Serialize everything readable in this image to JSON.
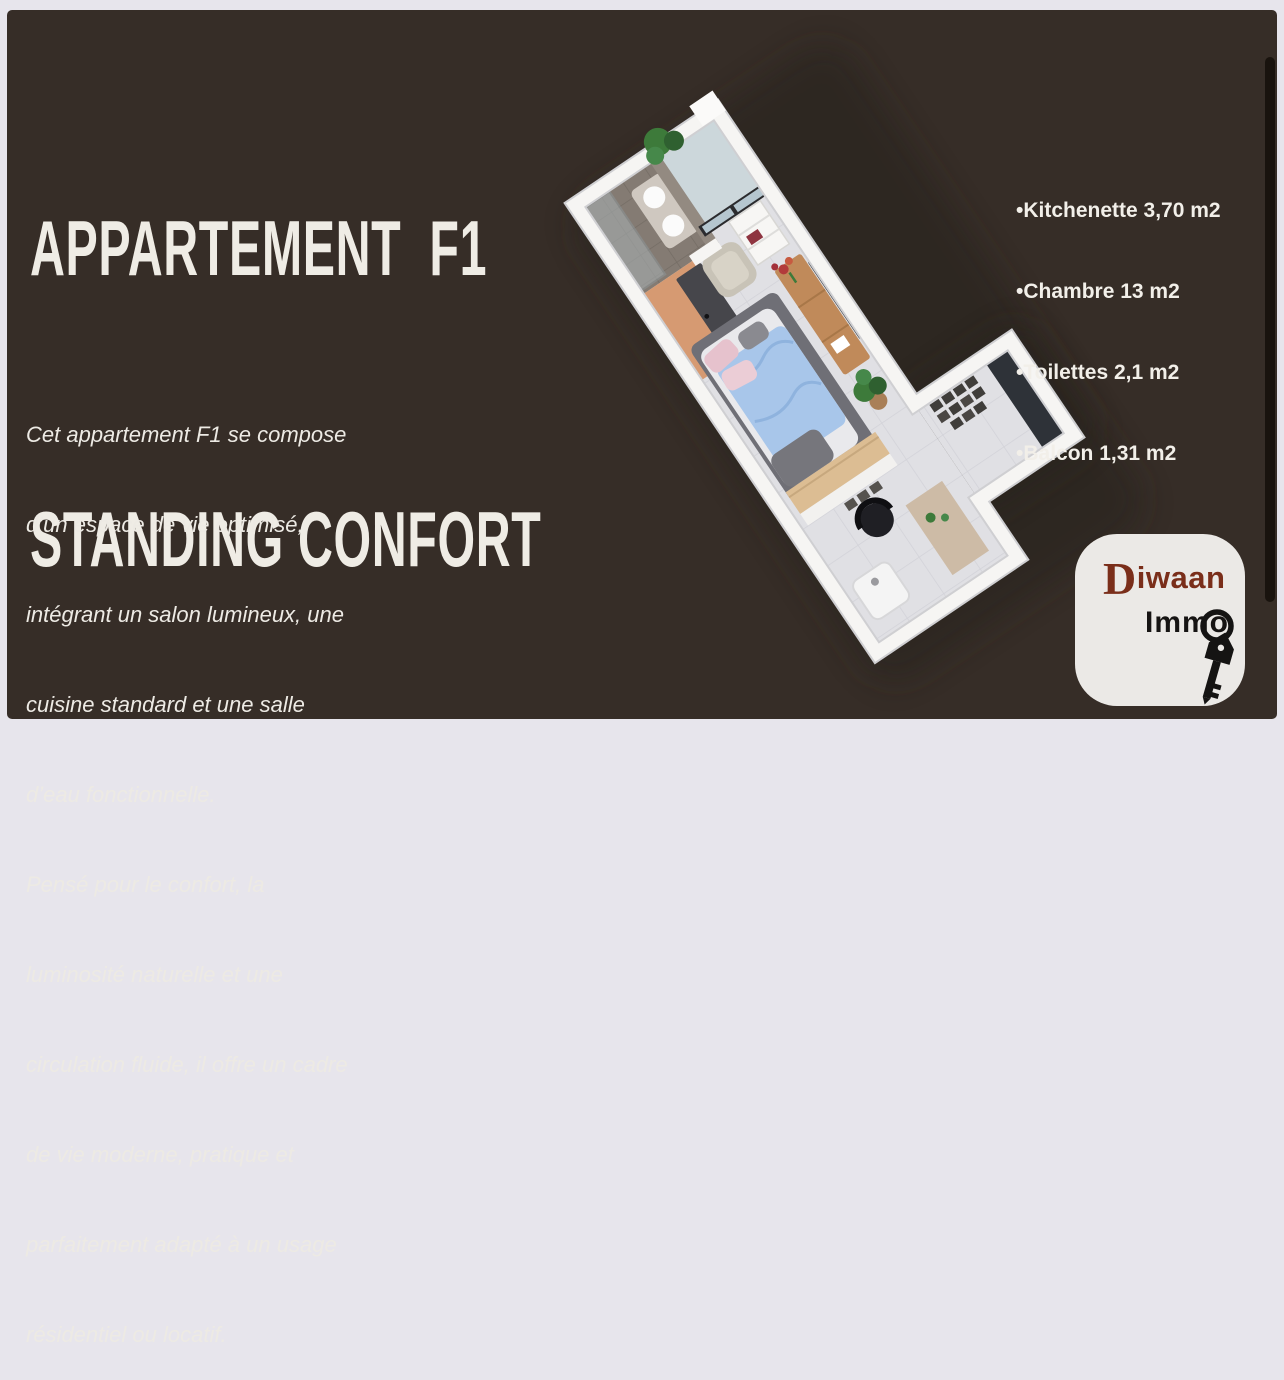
{
  "frame": {
    "outer_bg": "#e7e5ec",
    "card_bg": "#362d27"
  },
  "title": {
    "line1": "APPARTEMENT  F1",
    "line2": "STANDING CONFORT",
    "color": "#efece5"
  },
  "areas": {
    "items": [
      "•Kitchenette 3,70 m2",
      "•Chambre 13 m2",
      "•Toilettes 2,1 m2",
      "•Balcon 1,31 m2"
    ]
  },
  "description": {
    "lines": [
      "Cet appartement F1 se compose",
      "d’un espace de vie optimisé,",
      "intégrant un salon lumineux, une",
      "cuisine standard et une salle",
      "d’eau fonctionnelle.",
      "Pensé pour le confort, la",
      "luminosité naturelle et une",
      "circulation fluide, il offre un cadre",
      "de vie moderne, pratique et",
      "parfaitement adapté à un usage",
      "résidentiel ou locatif."
    ]
  },
  "logo": {
    "brand_initial": "D",
    "brand_rest": "iwaan",
    "sub": "Immo",
    "brand_color": "#7a2e1a",
    "sub_color": "#161413",
    "box_bg": "#ebe9e6"
  },
  "scrollbar": {
    "color": "#19130e"
  },
  "floor_plan": {
    "kind": "3d-isometric-apartment-render",
    "palette": {
      "walls": "#f6f5f3",
      "wall_edge": "#cfcfd2",
      "floor_tile": "#e0e0e4",
      "bathroom_tile": "#847b73",
      "wardrobe_orange": "#d69a72",
      "door_dark": "#46464b",
      "balcony_glass": "#b5c6cf",
      "bed_blue": "#a8c6ea",
      "bed_pink": "#e6c2cd",
      "rug_gray": "#6f6f76",
      "wood": "#c08a5a",
      "tv_dark": "#25282d",
      "plant_green": "#3d7a3a",
      "shadow": "#28201b"
    }
  }
}
